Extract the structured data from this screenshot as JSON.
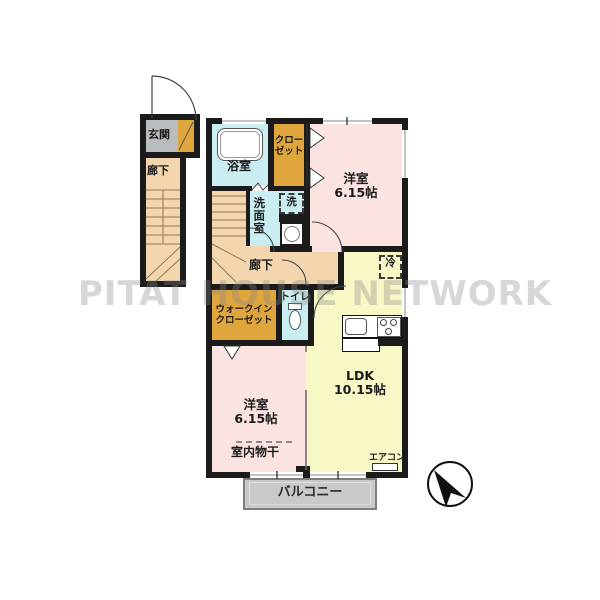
{
  "watermark": "PITAT HOUSE NETWORK",
  "floorplan": {
    "entrance": {
      "label": "玄関"
    },
    "corridor_left": {
      "label": "廊下"
    },
    "bath": {
      "label": "浴室"
    },
    "closet": {
      "label_line1": "クロー",
      "label_line2": "ゼット"
    },
    "bedroom1": {
      "label": "洋室",
      "size": "6.15帖"
    },
    "laundry": {
      "label": "洗"
    },
    "washroom": {
      "label": "洗面室"
    },
    "corridor": {
      "label": "廊下"
    },
    "walk_in_closet": {
      "label_line1": "ウォークイン",
      "label_line2": "クローゼット"
    },
    "toilet": {
      "label": "トイレ"
    },
    "refrigerator": {
      "label": "冷"
    },
    "ldk": {
      "label": "LDK",
      "size": "10.15帖"
    },
    "bedroom2": {
      "label": "洋室",
      "size": "6.15帖"
    },
    "indoor_drying": {
      "label": "室内物干"
    },
    "aircon": {
      "label": "エアコン"
    },
    "balcony": {
      "label": "バルコニー"
    }
  },
  "colors": {
    "wall": "#1b1b1b",
    "room_pink": "#fbe3e2",
    "room_yellow": "#f8f8c6",
    "wet_blue": "#c9edf1",
    "closet_orange": "#dfa63e",
    "hall_peach": "#f4d6ae",
    "entrance_gray": "#b9bdbf",
    "balcony_gray": "#c9c9c9",
    "watermark_gray": "#878787"
  }
}
